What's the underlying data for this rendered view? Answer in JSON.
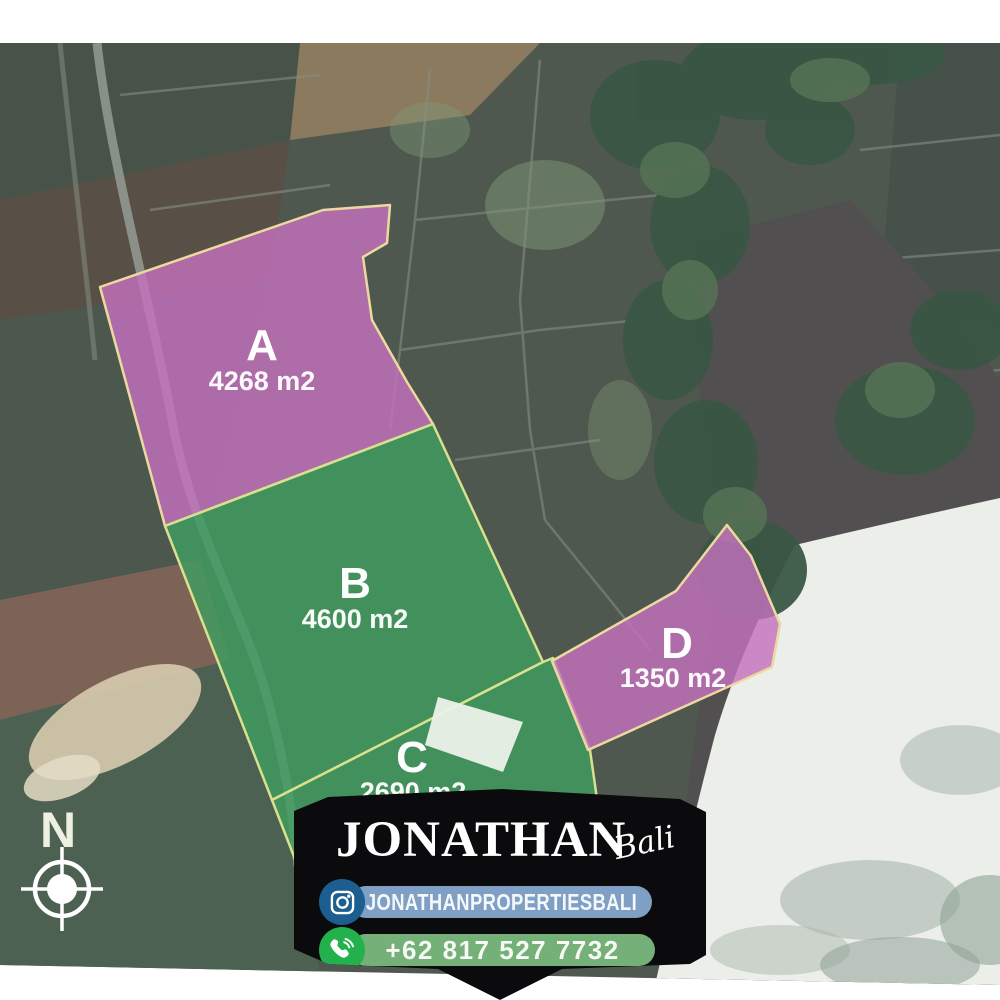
{
  "map": {
    "kind": "satellite-land-plot-listing",
    "plots": [
      {
        "id": "A",
        "label": "A",
        "area": "4268 m2",
        "fill": "#c372bd",
        "stroke": "#ecd9a0"
      },
      {
        "id": "B",
        "label": "B",
        "area": "4600 m2",
        "fill": "#3f9e60",
        "stroke": "#d9e08e"
      },
      {
        "id": "C",
        "label": "C",
        "area": "2690 m2",
        "fill": "#3f9e60",
        "stroke": "#d9e08e"
      },
      {
        "id": "D",
        "label": "D",
        "area": "1350 m2",
        "fill": "#c372bd",
        "stroke": "#ecd9a0"
      }
    ],
    "compass": {
      "north_label": "N"
    }
  },
  "banner": {
    "brand": "JONATHAN",
    "brand_script": "Bali",
    "background": "#0b0b0d",
    "instagram": {
      "handle": "JONATHANPROPERTIESBALI",
      "icon": "instagram-icon",
      "badge_color": "#1c5e8f",
      "pill_color": "#7fa0c4"
    },
    "phone": {
      "number": "+62 817 527 7732",
      "icon": "phone-icon",
      "badge_color": "#22b14c",
      "pill_color": "#74b077"
    }
  }
}
